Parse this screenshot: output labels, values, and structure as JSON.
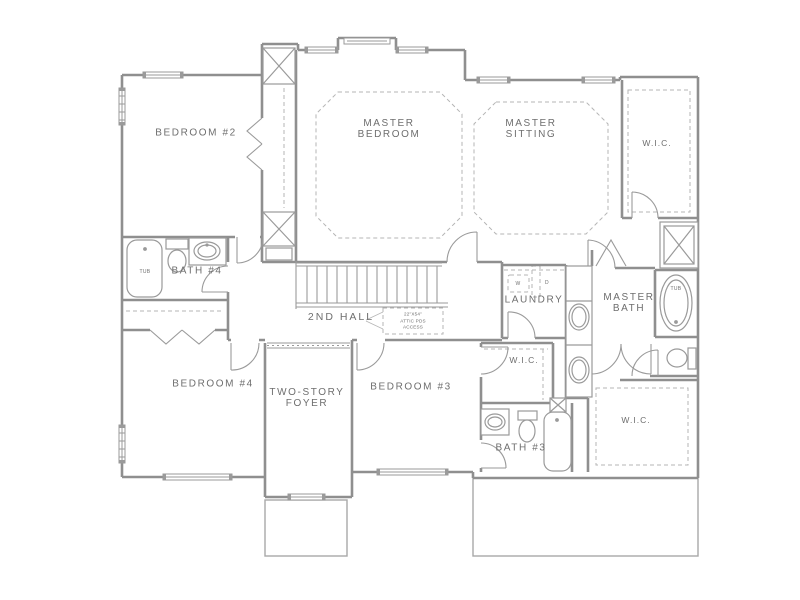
{
  "drawing_type": "floor-plan",
  "colors": {
    "wall": "#8f8f8f",
    "fixture": "#9a9a9a",
    "dashed": "#b5b5b5",
    "text": "#6e6e6e",
    "background": "#ffffff"
  },
  "labels": {
    "bedroom2": "BEDROOM #2",
    "bedroom3": "BEDROOM #3",
    "bedroom4": "BEDROOM #4",
    "master_bedroom": {
      "line1": "MASTER",
      "line2": "BEDROOM"
    },
    "master_sitting": {
      "line1": "MASTER",
      "line2": "SITTING"
    },
    "master_bath": {
      "line1": "MASTER",
      "line2": "BATH"
    },
    "foyer": {
      "line1": "TWO-STORY",
      "line2": "FOYER"
    },
    "hall": "2ND HALL",
    "laundry": "LAUNDRY",
    "bath3": "BATH #3",
    "bath4": "BATH #4",
    "wic_master": "W.I.C.",
    "wic_bedroom3": "W.I.C.",
    "wic_bottom": "W.I.C.",
    "tub_bath4": "TUB",
    "tub_master": "TUB",
    "washer": "W",
    "dryer": "D",
    "attic_note": {
      "line1": "22\"X54\"",
      "line2": "ATTIC PDS",
      "line3": "ACCESS"
    }
  }
}
